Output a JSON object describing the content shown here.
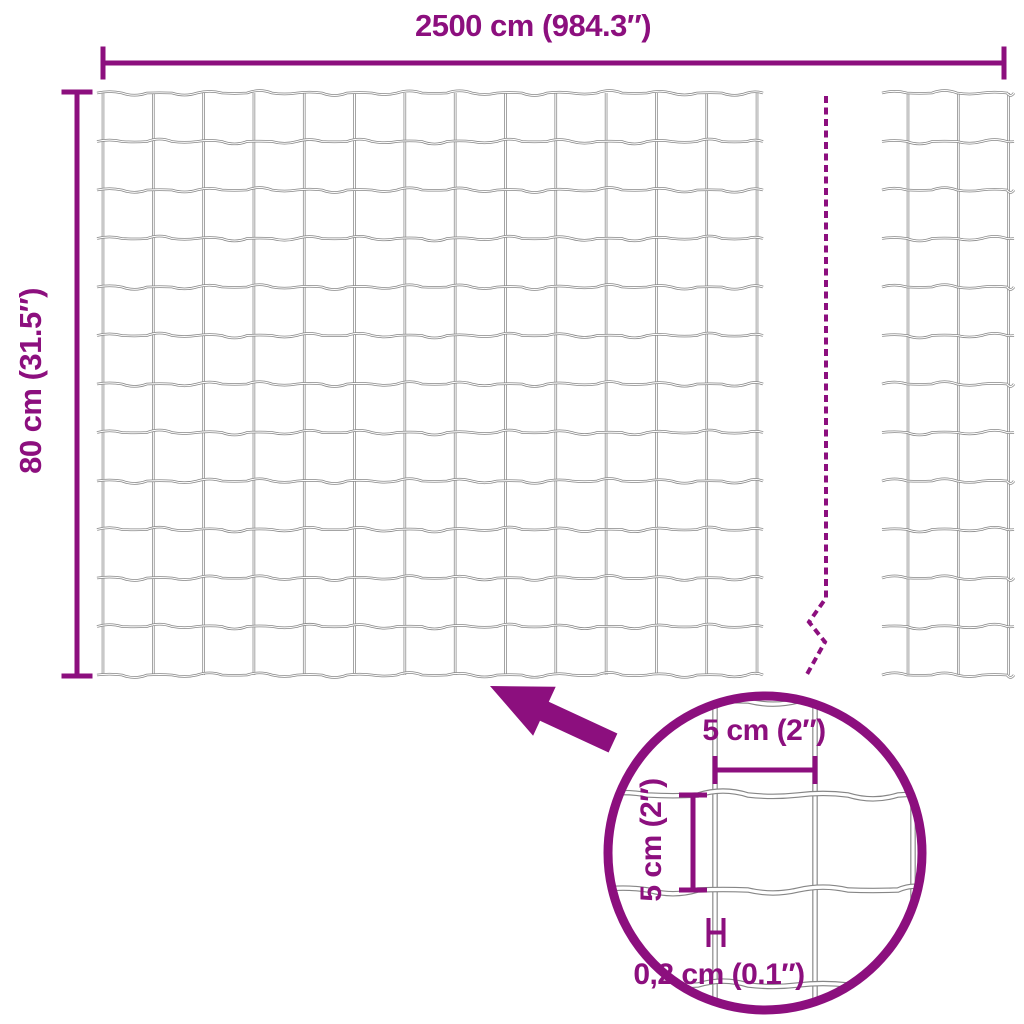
{
  "labels": {
    "total_width": "2500 cm (984.3″)",
    "total_height": "80 cm (31.5″)",
    "cell_width": "5 cm (2″)",
    "cell_height": "5 cm (2″)",
    "wire_thickness": "0,2 cm (0.1″)"
  },
  "icons": {
    "arrow": "zoom-pointer-arrow",
    "circle": "magnifier-circle",
    "break_line": "continuation-dashed-line"
  },
  "colors": {
    "accent": "#8C0F7E",
    "wire": "#868686",
    "wire_core": "#FFFFFF",
    "background": "#FFFFFF"
  },
  "geometry": {
    "canvas": {
      "w": 1024,
      "h": 1024
    },
    "fence_main": {
      "x0": 103,
      "y0": 93,
      "cols": 14,
      "col_gap": 50.31,
      "rows": 13,
      "row_gap": 48.5,
      "overhang": 6,
      "amp": 5,
      "seg": 25
    },
    "fence_right": {
      "wire_x0": 882,
      "wire_x1": 1014,
      "col_xs": [
        908,
        958.3,
        1008.6
      ]
    },
    "dashed_line": {
      "x": 826,
      "y0": 96,
      "zigzag": [
        [
          826,
          598
        ],
        [
          809,
          622
        ],
        [
          825,
          642
        ],
        [
          806,
          676
        ]
      ],
      "dash": "7 4.5",
      "width": 4
    },
    "dim_top": {
      "y": 63,
      "x0": 103,
      "x1": 1004,
      "cap": 16.5,
      "stroke": 5
    },
    "dim_left": {
      "x": 77,
      "y0": 92,
      "y1": 676,
      "cap": 15.5,
      "stroke": 5
    },
    "detail_circle": {
      "cx": 765,
      "cy": 853,
      "r": 157,
      "stroke": 9
    },
    "detail_mesh": {
      "col_xs": [
        715,
        815,
        913
      ],
      "row_ys": [
        701,
        795,
        890,
        985
      ],
      "x0": 598,
      "x1": 932,
      "y0": 688,
      "y1": 1016,
      "amp": 8,
      "seg": 50
    },
    "detail_dim_w": {
      "y": 770,
      "x0": 715,
      "x1": 815,
      "cap": 14,
      "stroke": 5
    },
    "detail_dim_h": {
      "x": 693,
      "y0": 795,
      "y1": 890,
      "cap": 14,
      "stroke": 5
    },
    "thickness_marker": {
      "x0": 708.5,
      "x1": 723.5,
      "y0": 918,
      "y1": 947,
      "stroke": 4
    },
    "arrow_points": "490,686 555.7,686.7 548.8,701.7 617.4,733.5 608.6,752.5 540,720.7 533.1,735.7",
    "wire_style": {
      "main_w": 2.6,
      "main_core": 1.1,
      "detail_w": 5.5,
      "detail_core": 3.2
    }
  }
}
